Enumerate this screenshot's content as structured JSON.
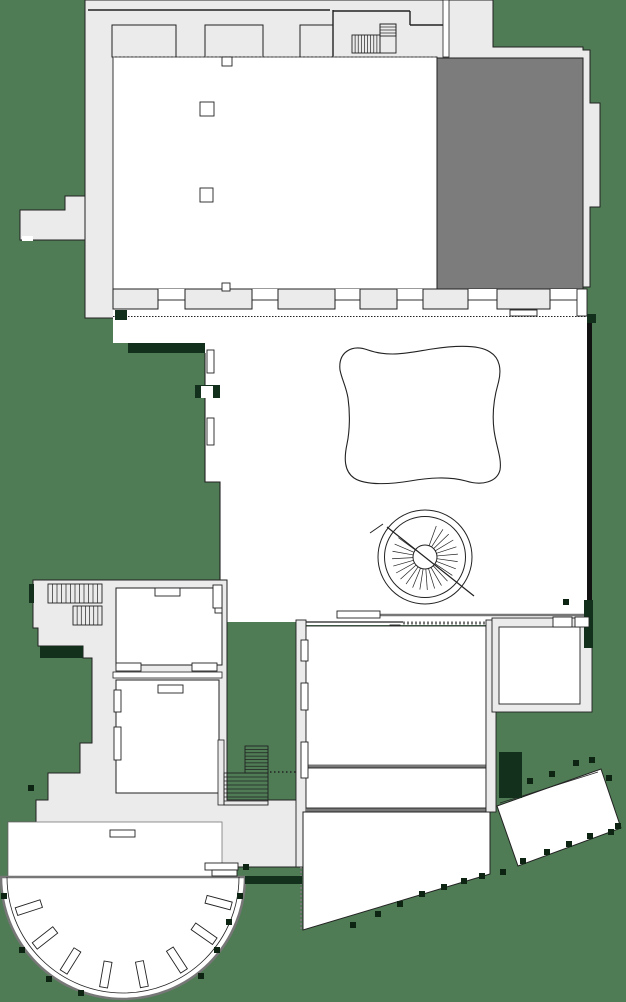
{
  "diagram": {
    "type": "architectural-floor-plan",
    "features": [
      "main-hall",
      "dark-gallery-room",
      "window-pier-row",
      "courtyard",
      "cushion-shaped-pond",
      "spiral-staircase",
      "left-stair-block",
      "rooms",
      "semicircular-terrace",
      "radial-benches",
      "south-wing",
      "angled-pavilion",
      "tree-markers",
      "hedge-walls"
    ]
  },
  "colors": {
    "background": "#4f7c55",
    "plan_base": "#ebebeb",
    "room": "#ffffff",
    "dark_room": "#7c7c7c",
    "line_dark": "#222222",
    "line_mid": "#777777",
    "hedge": "#12301b",
    "tree": "#0d2413"
  },
  "plan": {
    "tree_size": 6,
    "stairs": [
      {
        "x": 352,
        "y": 35,
        "w": 28,
        "h": 18,
        "n": 9,
        "dir": "v"
      },
      {
        "x": 380,
        "y": 24,
        "w": 16,
        "h": 29,
        "n": 0,
        "dir": "h"
      },
      {
        "x": 380,
        "y": 24,
        "w": 16,
        "h": 12,
        "n": 4,
        "dir": "h"
      },
      {
        "x": 48,
        "y": 584,
        "w": 54,
        "h": 19,
        "n": 12,
        "dir": "v"
      },
      {
        "x": 73,
        "y": 606,
        "w": 29,
        "h": 19,
        "n": 7,
        "dir": "v"
      },
      {
        "x": 245,
        "y": 746,
        "w": 23,
        "h": 27,
        "n": 8,
        "dir": "h"
      },
      {
        "x": 224,
        "y": 773,
        "w": 44,
        "h": 32,
        "n": 8,
        "dir": "h"
      }
    ],
    "fan": {
      "cx": 425,
      "cy": 557,
      "r1": 12,
      "r2": 33,
      "from": -70,
      "to": 218,
      "step": 13
    },
    "piers": {
      "y": 289,
      "h": 20,
      "items": [
        [
          113,
          45
        ],
        [
          185,
          67
        ],
        [
          278,
          57
        ],
        [
          360,
          37
        ],
        [
          423,
          45
        ],
        [
          497,
          53
        ]
      ]
    },
    "windows": [
      [
        155,
        588,
        25,
        8
      ],
      [
        158,
        685,
        25,
        8
      ],
      [
        116,
        663,
        25,
        8
      ],
      [
        192,
        663,
        25,
        8
      ],
      [
        110,
        830,
        25,
        7
      ],
      [
        510,
        310,
        27,
        6
      ],
      [
        337,
        611,
        43,
        7
      ],
      [
        222,
        57,
        10,
        9
      ],
      [
        222,
        283,
        8,
        8
      ],
      [
        200,
        102,
        14,
        14
      ],
      [
        200,
        188,
        13,
        14
      ]
    ],
    "jambs": [
      [
        207,
        350,
        7,
        23
      ],
      [
        207,
        418,
        7,
        27
      ],
      [
        114,
        690,
        7,
        22
      ],
      [
        114,
        727,
        7,
        33
      ],
      [
        215,
        604,
        7,
        9
      ],
      [
        301,
        640,
        7,
        21
      ],
      [
        301,
        683,
        7,
        27
      ],
      [
        301,
        742,
        7,
        36
      ]
    ],
    "doors": [
      [
        205,
        863,
        33,
        7
      ],
      [
        212,
        870,
        25,
        6
      ],
      [
        577,
        289,
        10,
        27
      ],
      [
        553,
        617,
        19,
        10
      ],
      [
        575,
        617,
        14,
        10
      ],
      [
        213,
        585,
        9,
        23
      ]
    ],
    "gaps": [
      [
        201,
        386,
        12,
        12
      ],
      [
        22,
        236,
        11,
        5
      ]
    ],
    "hedges": [
      [
        40,
        646,
        43,
        12
      ],
      [
        128,
        343,
        77,
        10
      ],
      [
        195,
        385,
        25,
        13
      ],
      [
        584,
        600,
        9,
        48
      ],
      [
        499,
        752,
        23,
        46
      ],
      [
        245,
        876,
        57,
        8
      ],
      [
        29,
        584,
        5,
        19
      ],
      [
        115,
        310,
        12,
        10
      ],
      [
        587,
        314,
        9,
        9
      ]
    ],
    "benches": {
      "cx": 123,
      "cy": 877,
      "r": 99,
      "w": 26,
      "h": 8,
      "angles": [
        15,
        35,
        57,
        79,
        100,
        122,
        142,
        162
      ]
    },
    "trees": [
      [
        28,
        785
      ],
      [
        1,
        893
      ],
      [
        19,
        947
      ],
      [
        46,
        976
      ],
      [
        78,
        990
      ],
      [
        198,
        973
      ],
      [
        214,
        947
      ],
      [
        226,
        919
      ],
      [
        237,
        893
      ],
      [
        243,
        864
      ],
      [
        350,
        922
      ],
      [
        375,
        911
      ],
      [
        397,
        901
      ],
      [
        419,
        891
      ],
      [
        441,
        884
      ],
      [
        461,
        878
      ],
      [
        479,
        873
      ],
      [
        500,
        869
      ],
      [
        520,
        858
      ],
      [
        544,
        849
      ],
      [
        566,
        841
      ],
      [
        587,
        833
      ],
      [
        608,
        829
      ],
      [
        615,
        823
      ],
      [
        527,
        778
      ],
      [
        549,
        771
      ],
      [
        573,
        760
      ],
      [
        589,
        757
      ],
      [
        606,
        775
      ],
      [
        563,
        599
      ]
    ]
  }
}
